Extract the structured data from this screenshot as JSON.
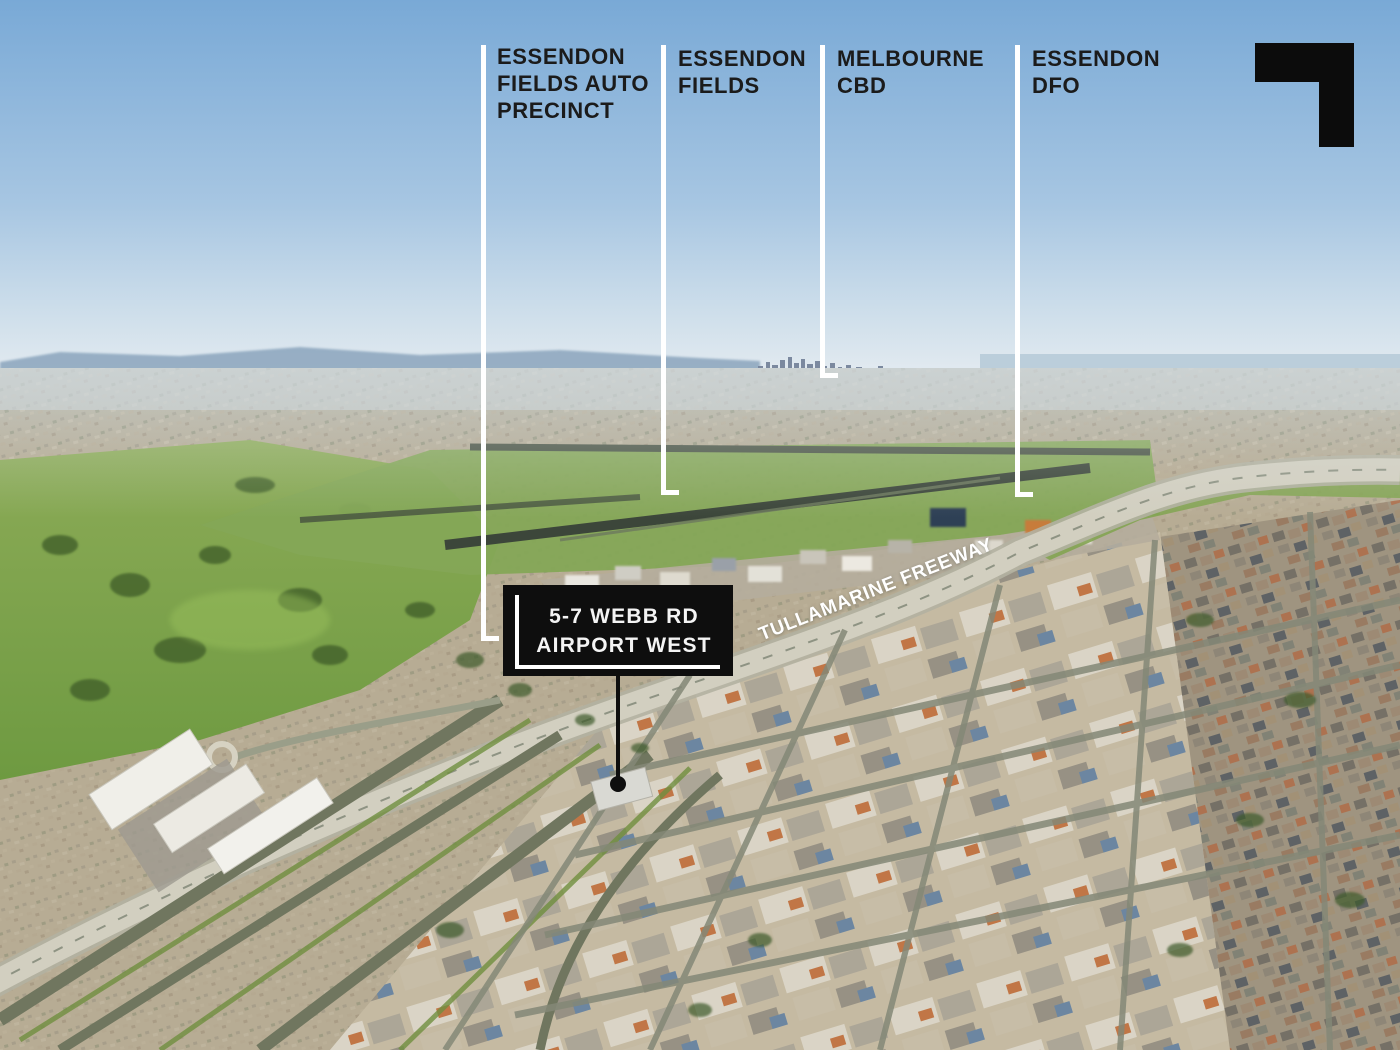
{
  "colors": {
    "callout_line": "#ffffff",
    "callout_text": "#1b1b1b",
    "logo_black": "#0c0c0c",
    "box_background": "#0e0e0e",
    "box_text": "#f4f4f4",
    "road_label_text": "#ffffff",
    "sky_top": "#79a9d6",
    "sky_horizon": "#e2eaf0"
  },
  "callouts": [
    {
      "id": "essendon-fields-auto-precinct",
      "lines": [
        "ESSENDON",
        "FIELDS AUTO",
        "PRECINCT"
      ]
    },
    {
      "id": "essendon-fields",
      "lines": [
        "ESSENDON",
        "FIELDS"
      ]
    },
    {
      "id": "melbourne-cbd",
      "lines": [
        "MELBOURNE",
        "CBD"
      ]
    },
    {
      "id": "essendon-dfo",
      "lines": [
        "ESSENDON",
        "DFO"
      ]
    }
  ],
  "property_marker": {
    "lines": [
      "5-7 WEBB RD",
      "AIRPORT WEST"
    ]
  },
  "road_label": {
    "text": "TULLAMARINE FREEWAY"
  },
  "logo": {
    "icon": "corner-mark-logo"
  }
}
